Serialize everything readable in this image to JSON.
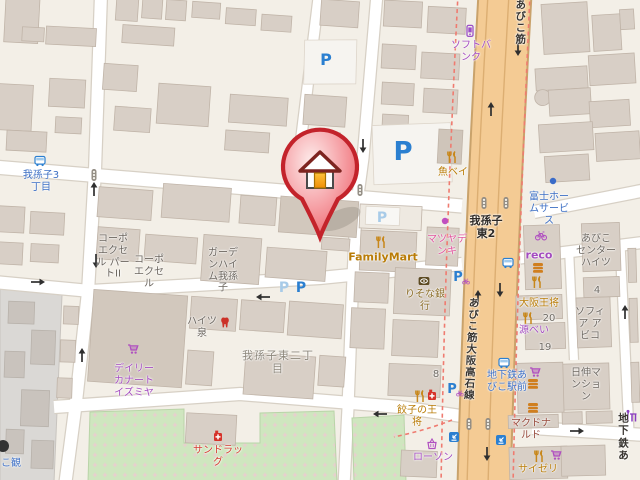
{
  "pois": {
    "softbank": "ソフトバ\nンク",
    "uobei": "魚ベイ",
    "fuji_home_service": "富士ホー\nムサービ\nス",
    "abiko_center_heights": "あびこ\nセンター\nハイツ",
    "reco": "reco",
    "osaka_ohsho": "大阪王将",
    "genbei": "源べい",
    "sophia_abiko": "ソフィ\nア ア\nビコ",
    "nisshin_mansion": "日伸マ\nンショ\nン",
    "mcdonalds": "マクドナ\nルド",
    "saizeriya": "サイゼリ",
    "lawson": "ローソン",
    "gyoza_no_ohsho": "餃子の王\n将",
    "matsuya_denki": "マツヤデ\nンキ",
    "familymart": "FamilyMart",
    "resona_bank": "りそな銀\n行",
    "daily_qanat_izumiya": "デイリー\nカナート\nイズミヤ",
    "sundrug": "サンドラッ\nグ",
    "corpo_excel_part2": "コーポ\nエクセ\nル パー\nトII",
    "corpo_excel": "コーポ\nエクセ\nル",
    "garden_heim_abiko": "ガーデ\nンハイ\nム我孫\n子",
    "heights_izumi": "ハイツ\n泉",
    "partial_left": "こ観"
  },
  "bus_stops": {
    "abiko3_chome": "我孫子3\n丁目",
    "chikatetsu_abiko_ekimae": "地下鉄あ\nびこ駅前"
  },
  "roads": {
    "abikosuji": "あびこ筋",
    "abikosuji_osakatakaishi": "あびこ筋大阪高石線",
    "chikatetsu_partial": "地下鉄あ"
  },
  "districts": {
    "abiko_higashi_2chome": "我孫子東二丁\n目",
    "abiko_higashi2_intersection": "我孫子\n東2"
  },
  "numbers": {
    "four": "4",
    "eight": "8",
    "nineteen": "19",
    "twenty": "20"
  },
  "parking": {
    "p": "P"
  },
  "colors": {
    "main_road": "#f4cb94",
    "route_dash": "#ef7b70",
    "park": "#cfe6bf",
    "pin_red": "#e8424a",
    "transit_blue": "#2b7fd0",
    "poi_orange": "#c8871a",
    "poi_purple": "#a44cc0"
  }
}
